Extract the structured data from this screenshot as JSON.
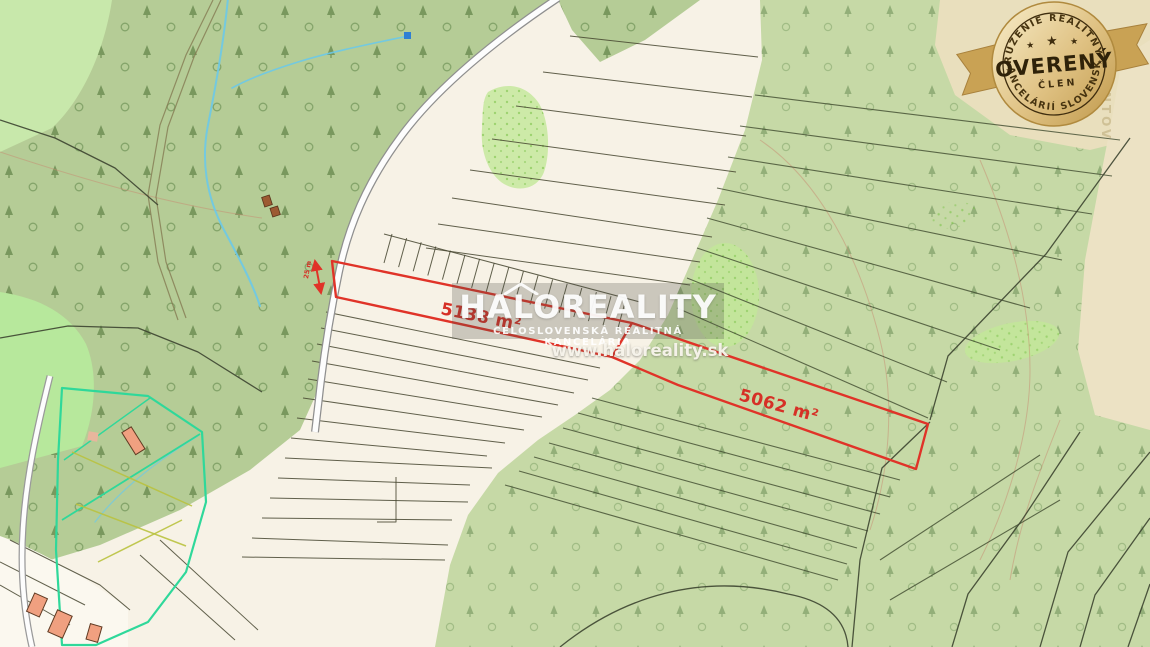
{
  "map": {
    "parcels": {
      "parcel1_area_label": "5138 m²",
      "parcel2_area_label": "5062 m²",
      "width_label": "25 m"
    },
    "faint_place_label": "LENTOV"
  },
  "watermark": {
    "brand": "HALOREALITY",
    "subtitle": "CELOSLOVENSKÁ REALITNÁ KANCELÁRIA",
    "url": "www.haloreality.sk"
  },
  "badge": {
    "top_text": "ZDRUŽENIE REALITNÝCH",
    "bottom_text": "KANCELÁRIÍ SLOVENSKA",
    "center_text": "OVERENÝ",
    "sub_text": "ČLEN",
    "stars": {
      "left": "★",
      "center": "★",
      "right": "★"
    },
    "side_dot_left": "★",
    "side_dot_right": "★"
  },
  "colors": {
    "parcel_red": "#e03328",
    "label_red": "#d63026",
    "field_cream": "#f7f2e6",
    "forest_green_left": "#b5cc96",
    "forest_green_right": "#c6d9a6",
    "bright_green": "#b7e89c",
    "beige": "#e9dfbd",
    "stream_blue": "#6cc9e8",
    "meadow_teal": "#2fd89a",
    "badge_gold": "#d9b96e",
    "badge_text": "#46330f"
  }
}
